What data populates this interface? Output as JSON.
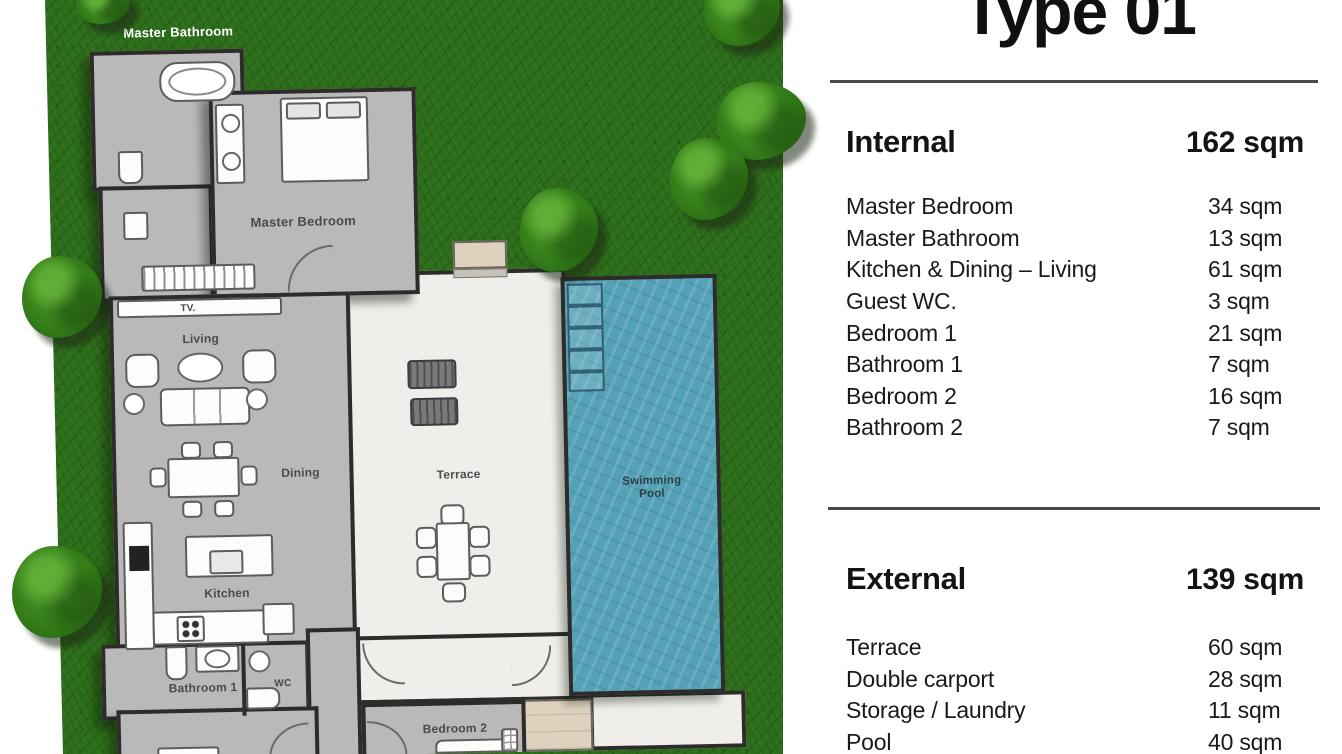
{
  "panel": {
    "title": "Type 01",
    "internal": {
      "label": "Internal",
      "total": "162 sqm",
      "rows": [
        {
          "label": "Master Bedroom",
          "value": "34 sqm"
        },
        {
          "label": "Master Bathroom",
          "value": "13 sqm"
        },
        {
          "label": "Kitchen & Dining – Living",
          "value": "61 sqm"
        },
        {
          "label": "Guest WC.",
          "value": "3 sqm"
        },
        {
          "label": "Bedroom 1",
          "value": "21 sqm"
        },
        {
          "label": "Bathroom 1",
          "value": "7 sqm"
        },
        {
          "label": "Bedroom 2",
          "value": "16 sqm"
        },
        {
          "label": "Bathroom 2",
          "value": "7 sqm"
        }
      ]
    },
    "external": {
      "label": "External",
      "total": "139 sqm",
      "rows": [
        {
          "label": "Terrace",
          "value": "60 sqm"
        },
        {
          "label": "Double carport",
          "value": "28 sqm"
        },
        {
          "label": "Storage / Laundry",
          "value": "11 sqm"
        },
        {
          "label": "Pool",
          "value": "40 sqm"
        }
      ]
    }
  },
  "floorplan": {
    "labels": {
      "master_bathroom": "Master Bathroom",
      "master_bedroom": "Master Bedroom",
      "tv": "TV.",
      "living": "Living",
      "dining": "Dining",
      "kitchen": "Kitchen",
      "bathroom1": "Bathroom 1",
      "wc": "WC",
      "terrace": "Terrace",
      "pool": "Swimming Pool",
      "bedroom2": "Bedroom 2"
    }
  },
  "colors": {
    "lawn": "#2f701c",
    "tree": "#327a18",
    "pool_water": "#55a2b7",
    "room_fill": "#b9b9b9",
    "wall": "#2e2b2b",
    "terrace_fill": "#efeeeb",
    "deck_beige": "#ded2bf",
    "panel_bg": "#ffffff",
    "panel_text": "#141414",
    "divider": "#4a4a4a"
  }
}
